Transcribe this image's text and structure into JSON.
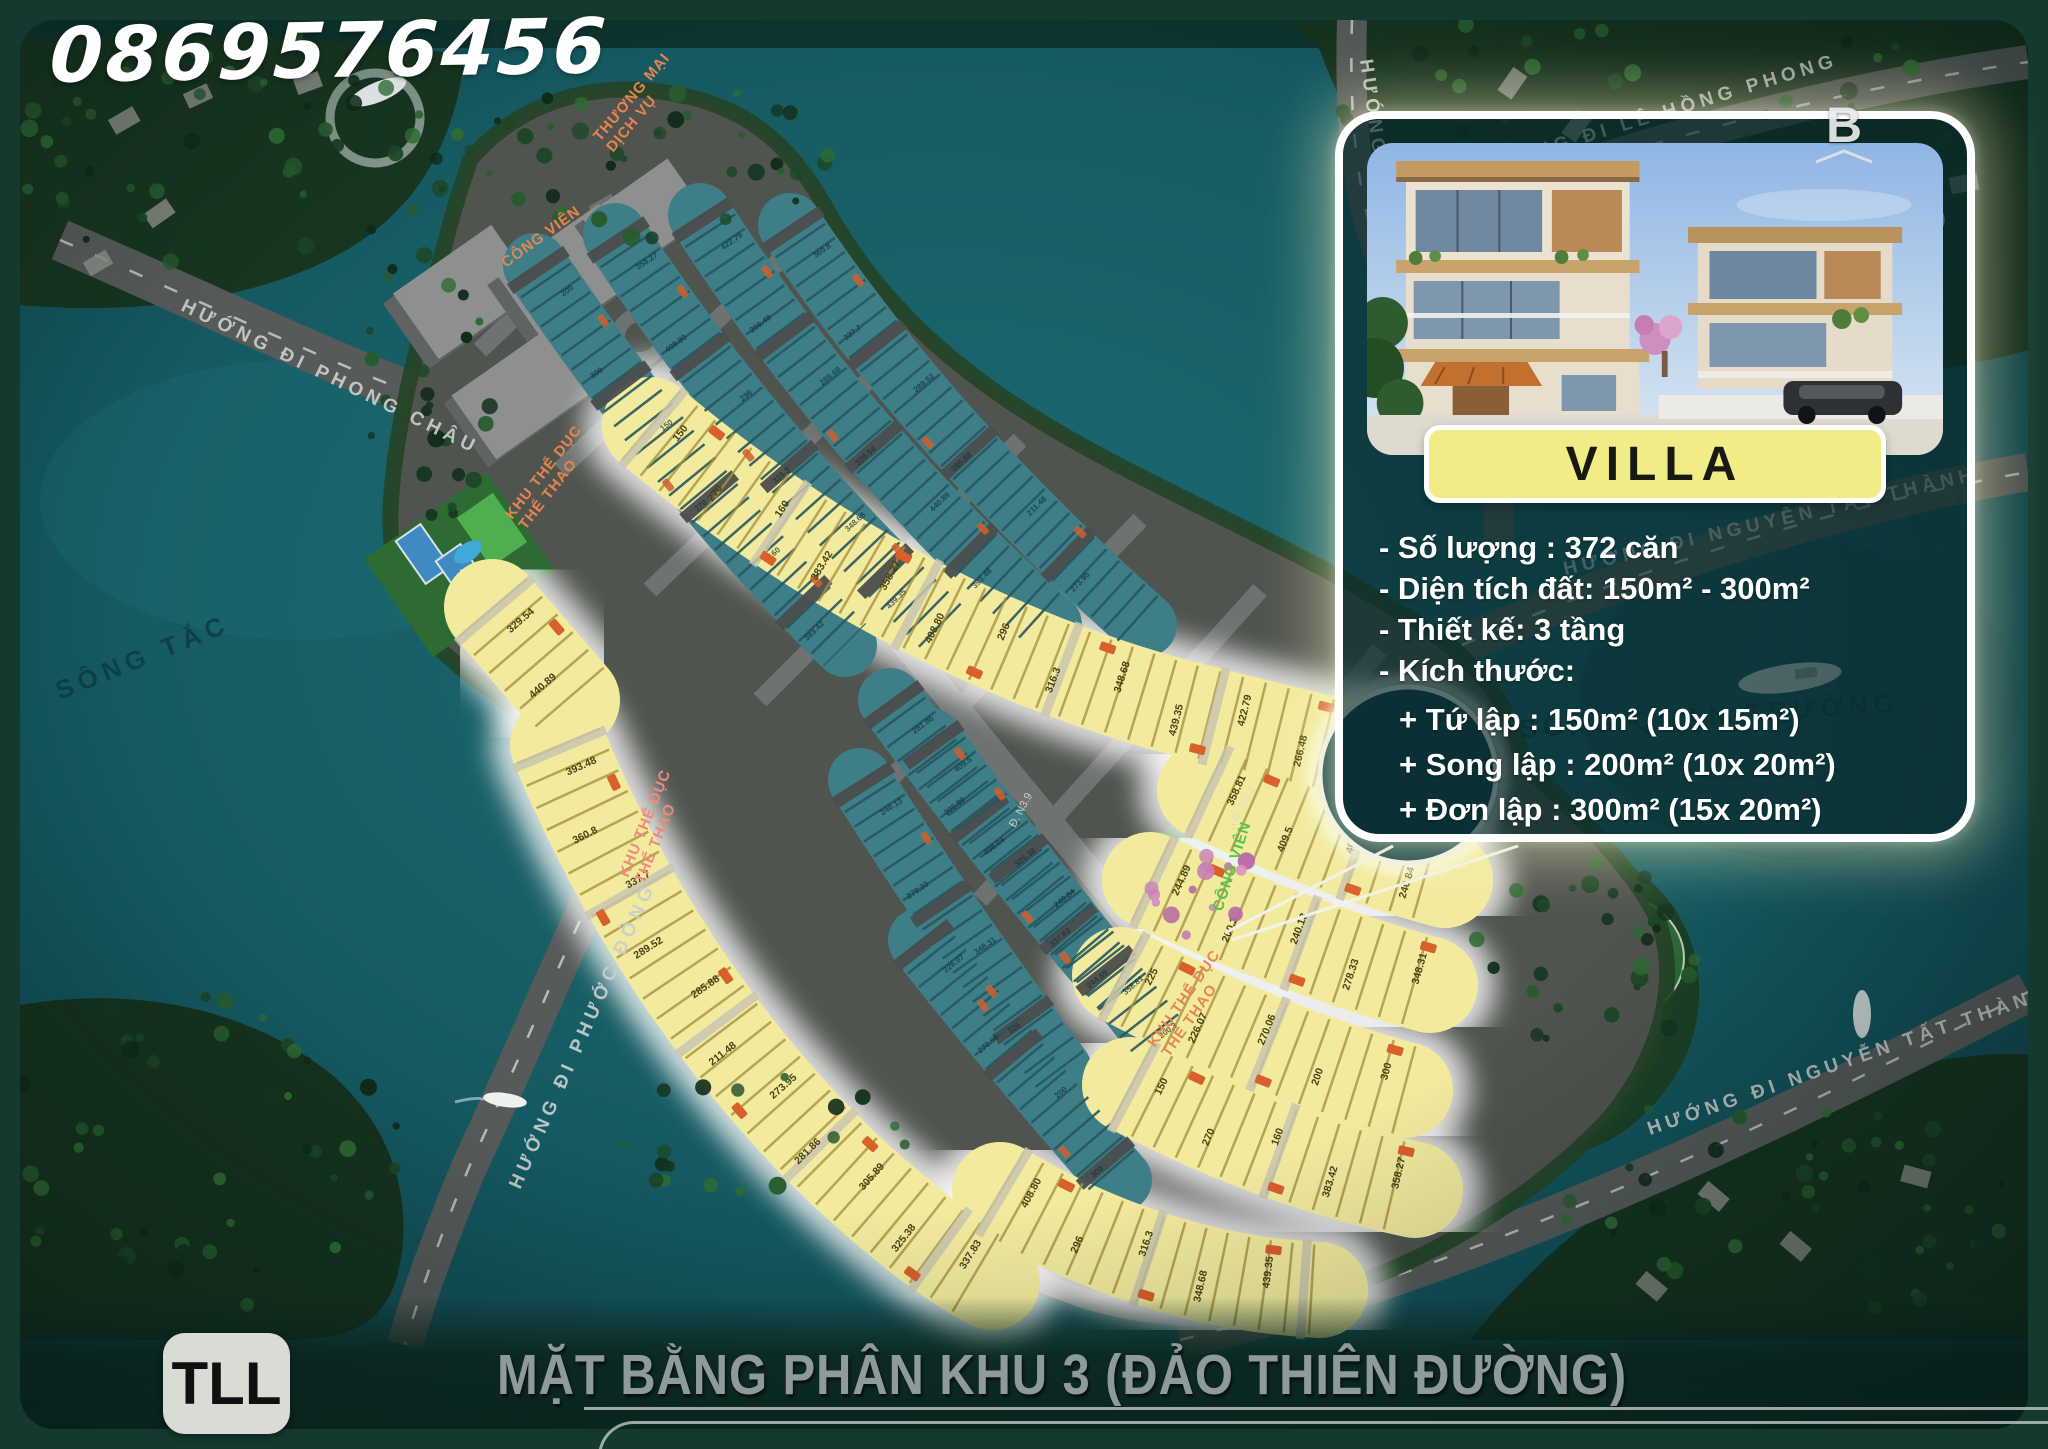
{
  "page": {
    "phone": "0869576456",
    "brand_badge": "TLL",
    "footer_title": "MẶT BẰNG PHÂN KHU 3 (ĐẢO THIÊN ĐƯỜNG)"
  },
  "villa_card": {
    "banner": "VILLA",
    "lines": [
      "- Số lượng : 372 căn",
      "- Diện tích đất: 150m² - 300m²",
      "- Thiết kế: 3 tầng",
      "- Kích thước:"
    ],
    "sub_lines": [
      "+  Tứ lập : 150m² (10x 15m²)",
      "+  Song lập : 200m² (10x 20m²)",
      "+  Đơn lập : 300m² (15x 20m²)"
    ]
  },
  "map": {
    "compass_north": "B",
    "compass_east": "Đ",
    "water_labels": [
      {
        "text": "SÔNG TẮC",
        "x": 60,
        "y": 700,
        "rot": -22
      },
      {
        "text": "SÔNG QUÂN TRƯỜNG",
        "x": 1520,
        "y": 738,
        "rot": -4
      }
    ],
    "road_labels": [
      {
        "text": "HƯỚNG ĐI PHONG CHÂU",
        "x": 180,
        "y": 310,
        "rot": 26
      },
      {
        "text": "HƯỚNG ĐI PHƯỚC ĐÔNG",
        "x": 520,
        "y": 1190,
        "rot": -66
      },
      {
        "text": "HƯỚNG ĐI QUỐC LỘ 1A",
        "x": 1360,
        "y": 60,
        "rot": 82
      },
      {
        "text": "HƯỚNG ĐI LÊ HỒNG PHONG",
        "x": 1480,
        "y": 175,
        "rot": -17
      },
      {
        "text": "HƯỚNG ĐI NGUYỄN TẤT THÀNH",
        "x": 1565,
        "y": 575,
        "rot": -13
      },
      {
        "text": "HƯỚNG ĐI NGUYỄN TẤT THÀNH",
        "x": 1650,
        "y": 1135,
        "rot": -19
      }
    ],
    "zone_labels": [
      {
        "text": "THƯƠNG MẠI\nDỊCH VỤ",
        "x": 600,
        "y": 142,
        "rot": -50,
        "color": "#e8854e"
      },
      {
        "text": "CÔNG VIÊN",
        "x": 506,
        "y": 268,
        "rot": -36,
        "color": "#e8854e"
      },
      {
        "text": "KHU THỂ DỤC\nTHỂ THAO",
        "x": 512,
        "y": 520,
        "rot": -52,
        "color": "#e8854e"
      },
      {
        "text": "KHU THỂ DỤC\nTHỂ THAO",
        "x": 628,
        "y": 878,
        "rot": -68,
        "color": "#ef8a7a"
      },
      {
        "text": "KHU THỂ DỤC\nTHỂ THAO",
        "x": 1155,
        "y": 1048,
        "rot": -55,
        "color": "#e8854e"
      },
      {
        "text": "CÔNG VIÊN",
        "x": 1222,
        "y": 912,
        "rot": -72,
        "color": "#54c24f"
      }
    ],
    "street_labels": [
      {
        "text": "Đ. N3.2",
        "x": 1238,
        "y": 822,
        "rot": -62
      },
      {
        "text": "Đ. N3.9",
        "x": 1015,
        "y": 828,
        "rot": -62
      }
    ],
    "lot_area_values_sample": [
      "200",
      "300",
      "150",
      "270",
      "160",
      "383.42",
      "358.27",
      "408.80",
      "296",
      "316.3",
      "348.68",
      "439.35",
      "422.79",
      "266.48",
      "286.68",
      "329.54",
      "440.89",
      "393.48",
      "360.8",
      "337.7",
      "289.52",
      "285.88",
      "211.48",
      "273.95",
      "281.86",
      "305.89",
      "325.38",
      "337.83",
      "358.81",
      "409.5",
      "408.04",
      "240.84",
      "244.89",
      "200.3",
      "240.13",
      "278.33",
      "348.31",
      "225",
      "226.07",
      "270.06"
    ]
  }
}
